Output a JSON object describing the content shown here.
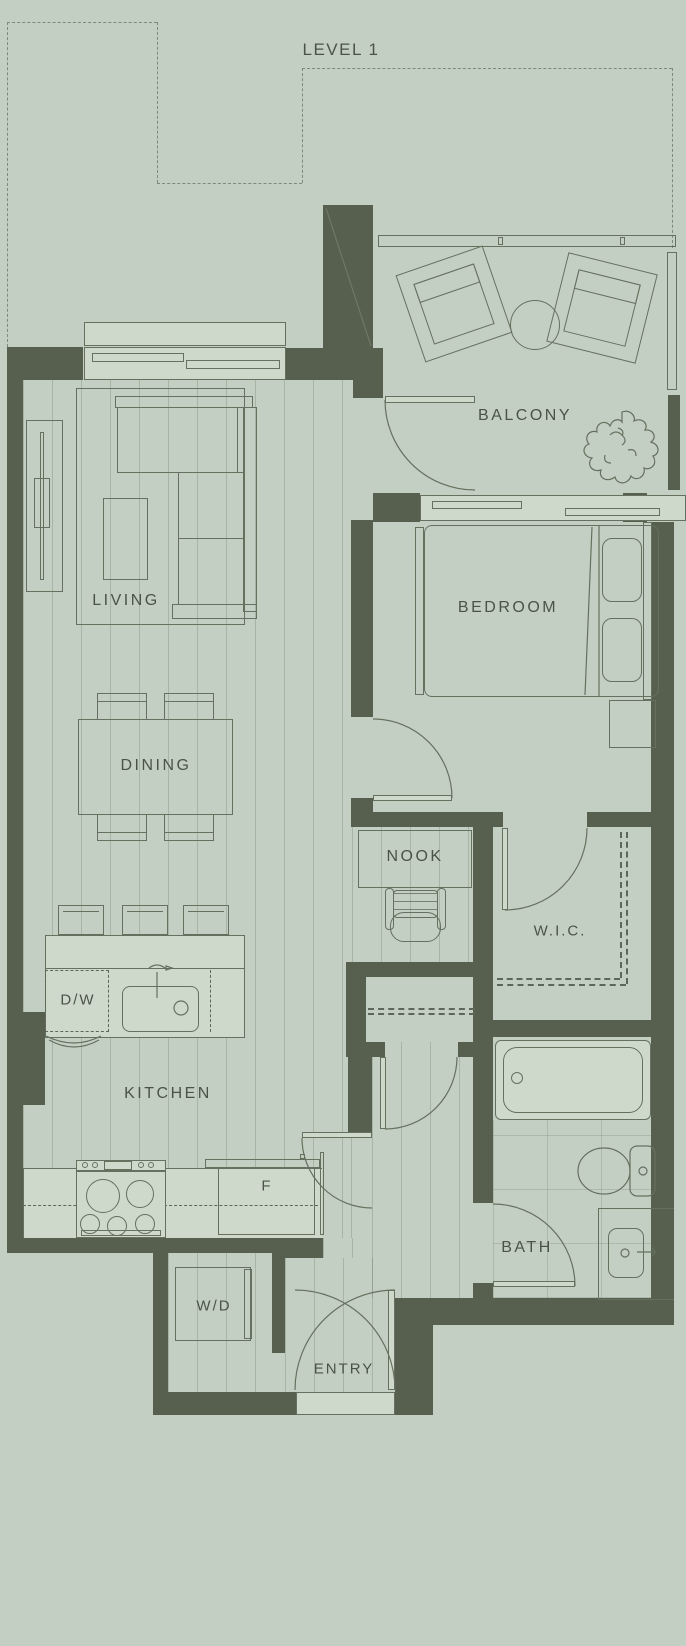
{
  "plan": {
    "title": "LEVEL 1",
    "rooms": {
      "balcony": "BALCONY",
      "living": "LIVING",
      "dining": "DINING",
      "kitchen": "KITCHEN",
      "bedroom": "BEDROOM",
      "nook": "NOOK",
      "wic": "W.I.C.",
      "bath": "BATH",
      "entry": "ENTRY"
    },
    "appliances": {
      "dishwasher": "D/W",
      "fridge": "F",
      "washer_dryer": "W/D"
    },
    "colors": {
      "background": "#c3cfc3",
      "wall": "#57604f",
      "line": "#66705f",
      "text": "#4b5348"
    }
  }
}
